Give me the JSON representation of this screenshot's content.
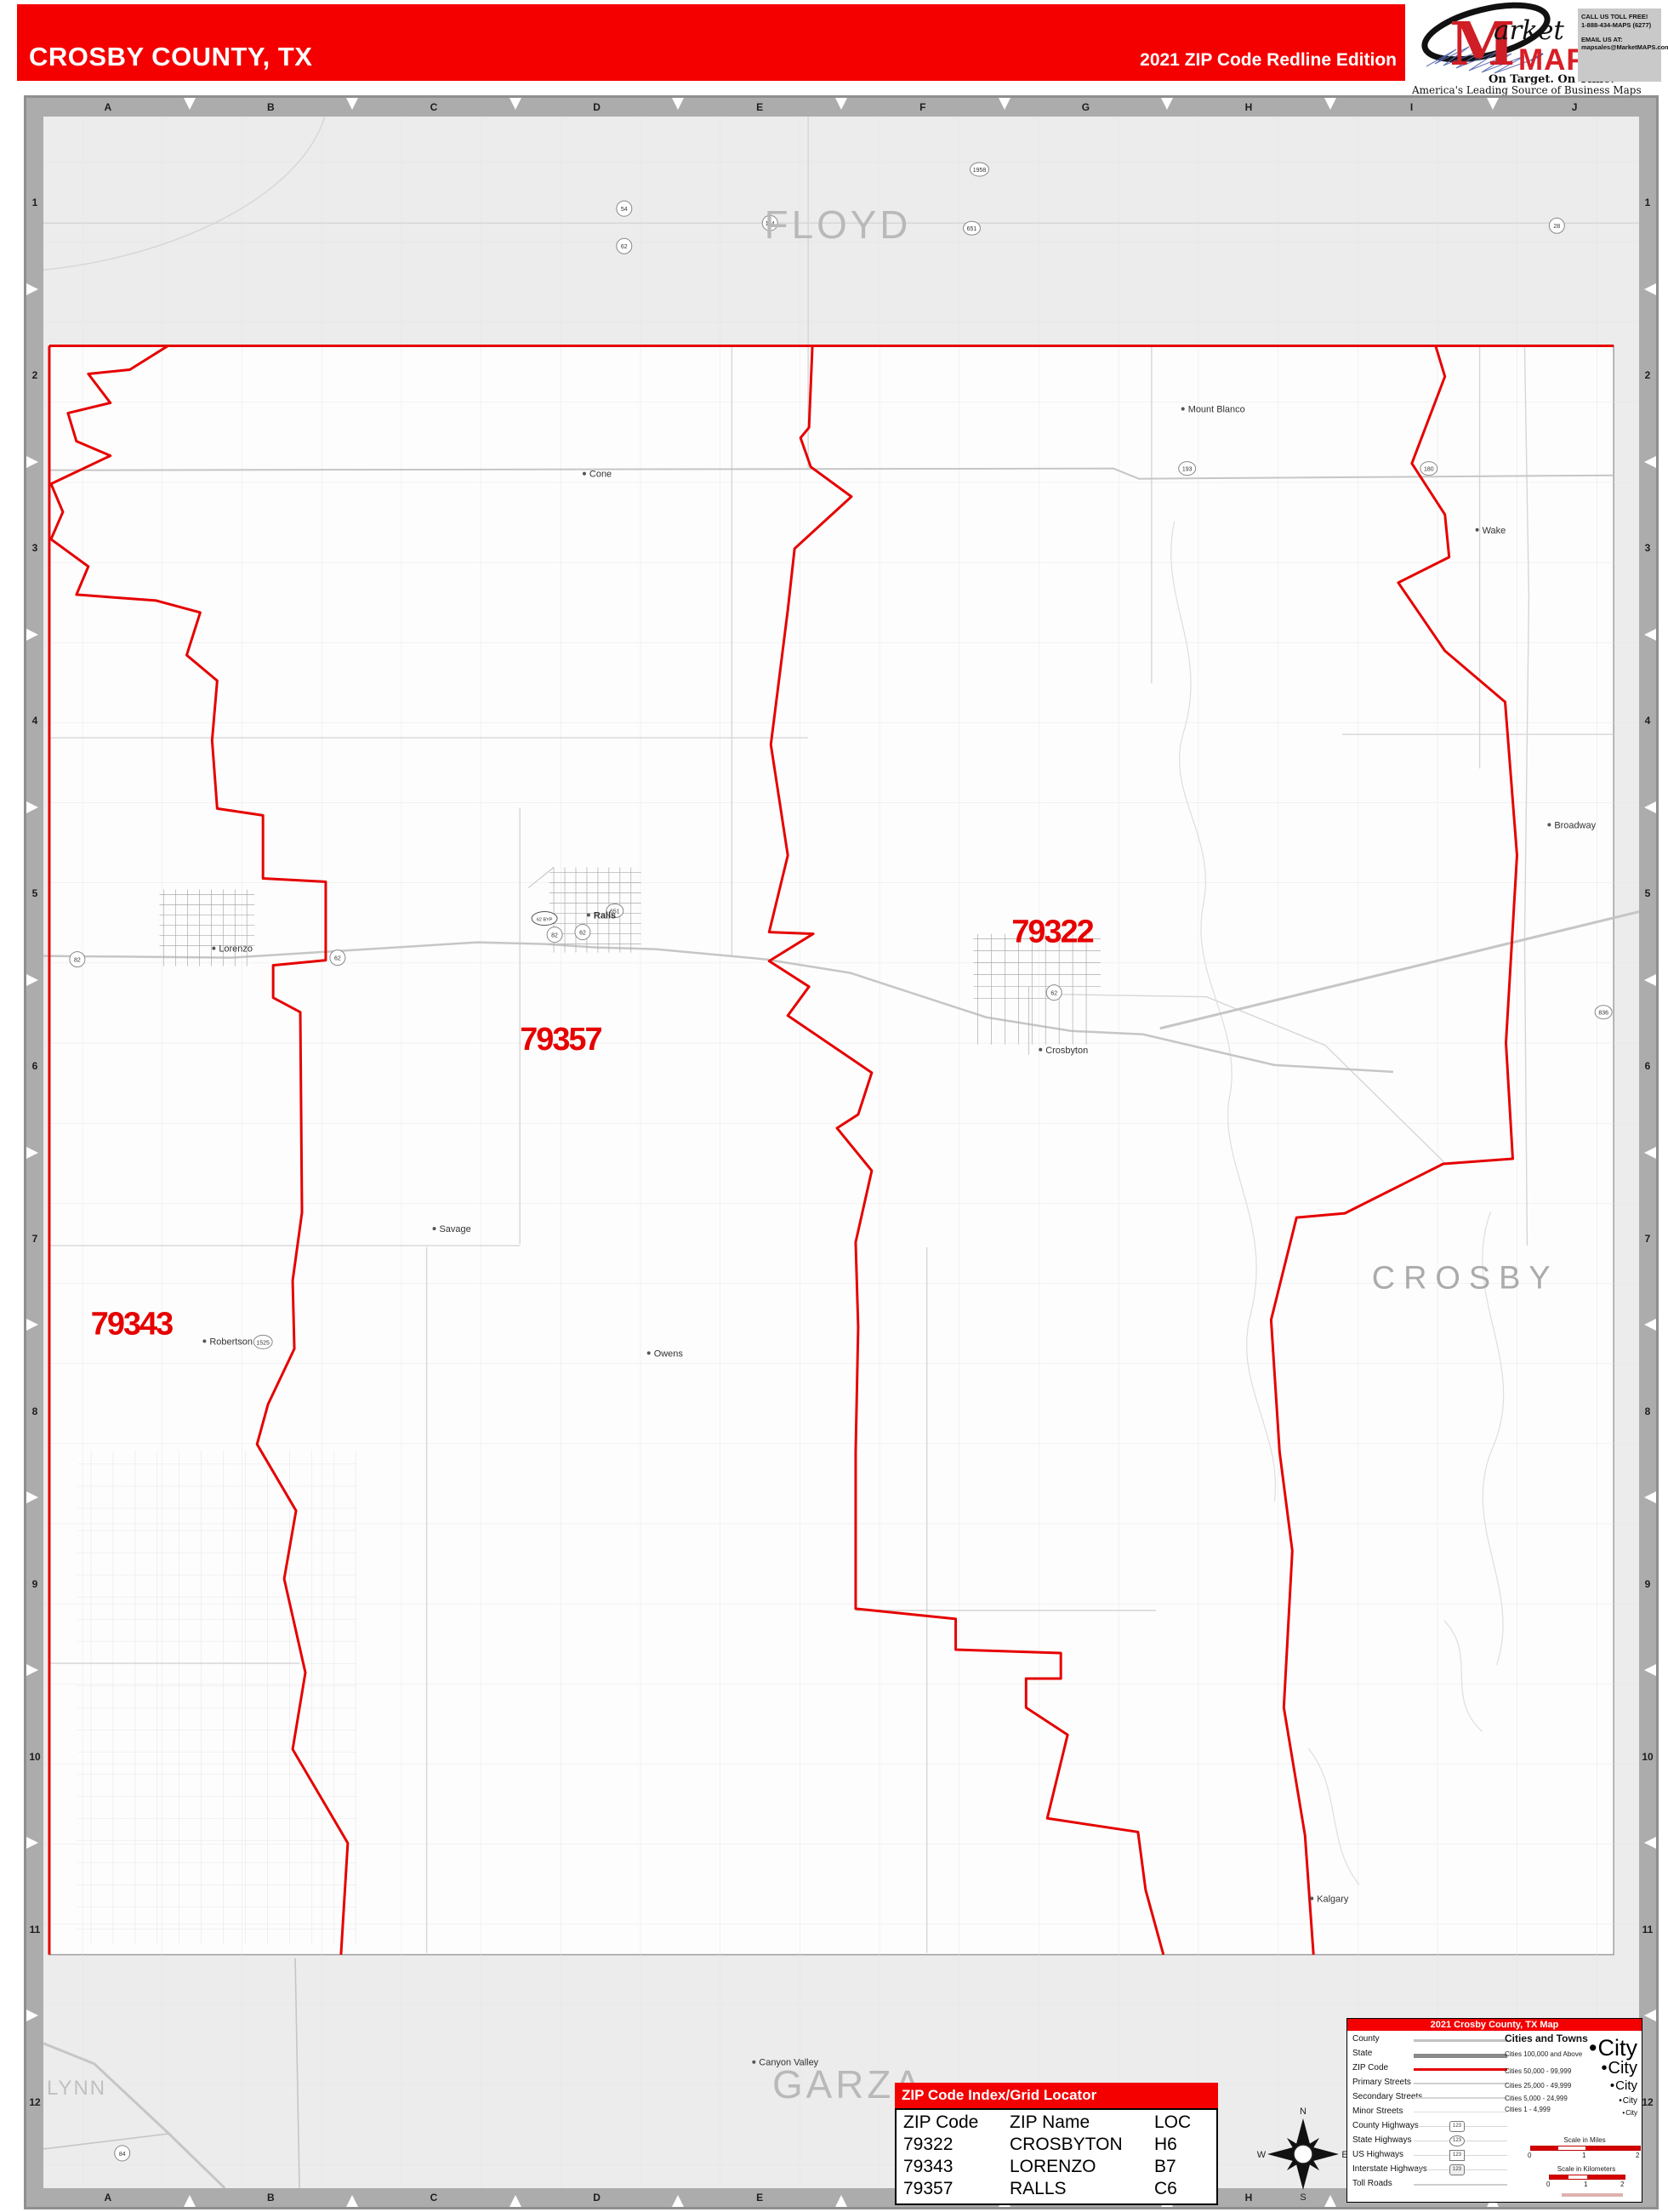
{
  "header": {
    "title": "CROSBY COUNTY, TX",
    "edition": "2021 ZIP Code Redline Edition"
  },
  "logo": {
    "m": "M",
    "market_rest": "arket",
    "maps": "MAPS",
    "tagline": "On Target.  On Time.",
    "subtitle": "America's Leading Source of  Business Maps",
    "call": "CALL US TOLL FREE!",
    "phone": "1-888-434-MAPS  (6277)",
    "email_label": "EMAIL US AT:",
    "email": "mapsales@MarketMAPS.com"
  },
  "rulers": {
    "letters": [
      "A",
      "B",
      "C",
      "D",
      "E",
      "F",
      "G",
      "H",
      "I",
      "J"
    ],
    "numbers": [
      "1",
      "2",
      "3",
      "4",
      "5",
      "6",
      "7",
      "8",
      "9",
      "10",
      "11",
      "12"
    ]
  },
  "map": {
    "counties": [
      {
        "name": "FLOYD"
      },
      {
        "name": "CROSBY"
      },
      {
        "name": "GARZA"
      },
      {
        "name": "LYNN"
      }
    ],
    "zips": [
      {
        "code": "79322"
      },
      {
        "code": "79357"
      },
      {
        "code": "79343"
      }
    ],
    "towns": [
      {
        "name": "Mount Blanco"
      },
      {
        "name": "Cone"
      },
      {
        "name": "Wake"
      },
      {
        "name": "Broadway"
      },
      {
        "name": "Savage"
      },
      {
        "name": "Owens"
      },
      {
        "name": "Robertson"
      },
      {
        "name": "Kalgary"
      },
      {
        "name": "Canyon Valley"
      },
      {
        "name": "Crosbyton"
      },
      {
        "name": "Lorenzo"
      },
      {
        "name": "Ralls"
      }
    ],
    "shields": [
      {
        "num": "54"
      },
      {
        "num": "62"
      },
      {
        "num": "1958"
      },
      {
        "num": "651"
      },
      {
        "num": "2591"
      },
      {
        "num": "28"
      },
      {
        "num": "114"
      },
      {
        "num": "193"
      },
      {
        "num": "180"
      },
      {
        "num": "82"
      },
      {
        "num": "62"
      },
      {
        "num": "62 BYP"
      },
      {
        "num": "82"
      },
      {
        "num": "62"
      },
      {
        "num": "651"
      },
      {
        "num": "62"
      },
      {
        "num": "1525"
      },
      {
        "num": "84"
      },
      {
        "num": "836"
      }
    ],
    "accent_color": "#e60000"
  },
  "legend": {
    "title": "2021 Crosby County, TX Map",
    "rows": [
      {
        "label": "County"
      },
      {
        "label": "State"
      },
      {
        "label": "ZIP Code"
      },
      {
        "label": "Primary Streets"
      },
      {
        "label": "Secondary Streets"
      },
      {
        "label": "Minor Streets"
      },
      {
        "label": "County Highways"
      },
      {
        "label": "State Highways"
      },
      {
        "label": "US Highways"
      },
      {
        "label": "Interstate Highways"
      },
      {
        "label": "Toll Roads"
      }
    ],
    "shield_sample": "123",
    "cities_title": "Cities and Towns",
    "city_rows": [
      {
        "label": "Cities 100,000 and Above",
        "sample": "City"
      },
      {
        "label": "Cities 50,000 - 99,999",
        "sample": "City"
      },
      {
        "label": "Cities 25,000 - 49,999",
        "sample": "City"
      },
      {
        "label": "Cities 5,000 - 24,999",
        "sample": "City"
      },
      {
        "label": "Cities 1 - 4,999",
        "sample": "City"
      }
    ],
    "scale_miles": {
      "label": "Scale in Miles",
      "ticks": [
        "0",
        "1",
        "2"
      ]
    },
    "scale_km": {
      "label": "Scale in Kilometers",
      "ticks": [
        "0",
        "1",
        "2"
      ]
    },
    "compass": {
      "n": "N",
      "e": "E",
      "s": "S",
      "w": "W"
    }
  },
  "index_table": {
    "title": "ZIP Code Index/Grid Locator",
    "columns": [
      "ZIP Code",
      "ZIP Name",
      "LOC"
    ],
    "rows": [
      [
        "79322",
        "CROSBYTON",
        "H6"
      ],
      [
        "79343",
        "LORENZO",
        "B7"
      ],
      [
        "79357",
        "RALLS",
        "C6"
      ]
    ]
  }
}
